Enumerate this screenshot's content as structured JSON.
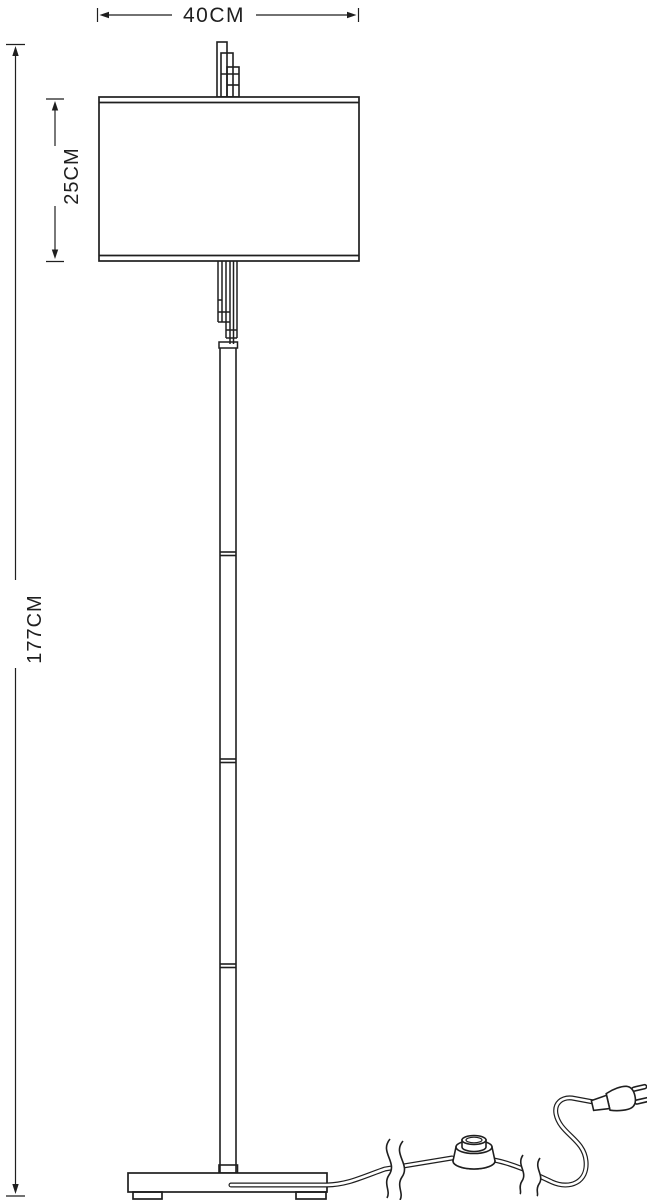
{
  "meta": {
    "colors": {
      "line": "#1f1f1f",
      "background": "#ffffff"
    }
  },
  "labels": {
    "width": "40CM",
    "shade_height": "25CM",
    "total_height": "177CM"
  }
}
